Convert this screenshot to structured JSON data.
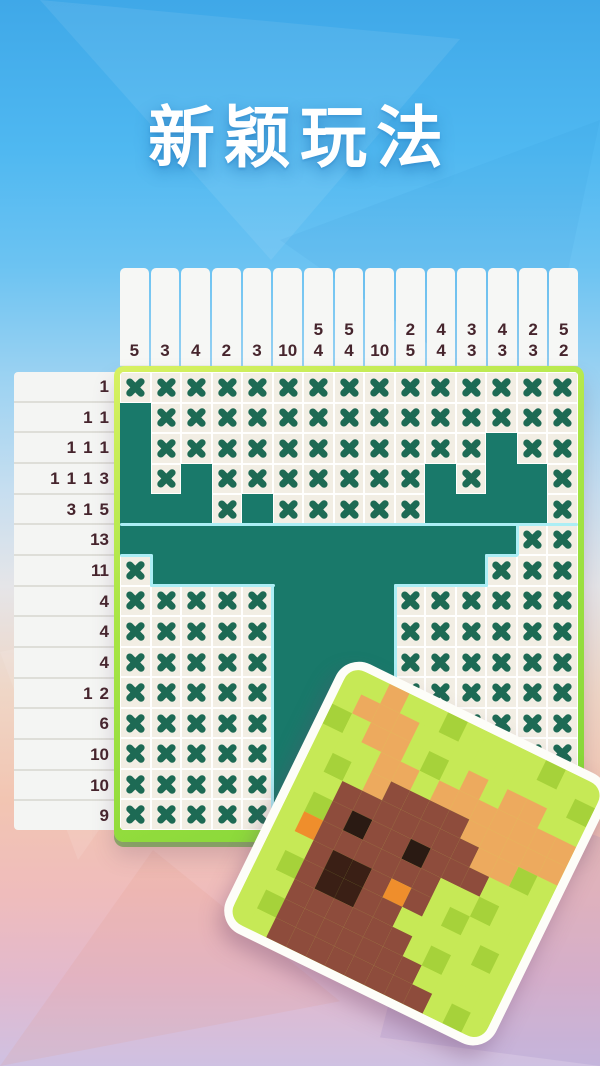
{
  "title": "新颖玩法",
  "colors": {
    "sky_blue": "#4fb8f1",
    "bottom_pink": "#efbcbc",
    "bottom_lavender": "#cfc1e2",
    "grid_border_green": "#a8e545",
    "cell_bg": "#f2eee4",
    "cell_filled_teal": "#19796a",
    "x_mark_green": "#1d6a54",
    "hint_text": "#46252d",
    "hint_strip_bg": "#f6f7f5",
    "highlight_cyan": "#aceef5",
    "card_border": "#fdfdf8"
  },
  "puzzle": {
    "size": 15,
    "col_hints": [
      [
        5
      ],
      [
        3
      ],
      [
        4
      ],
      [
        2
      ],
      [
        3
      ],
      [
        10
      ],
      [
        5,
        4
      ],
      [
        5,
        4
      ],
      [
        10
      ],
      [
        2,
        5
      ],
      [
        4,
        4
      ],
      [
        3,
        3
      ],
      [
        4,
        3
      ],
      [
        2,
        3
      ],
      [
        5,
        2
      ]
    ],
    "row_hints": [
      [
        1
      ],
      [
        1,
        1
      ],
      [
        1,
        1,
        1
      ],
      [
        1,
        1,
        1,
        3
      ],
      [
        3,
        1,
        5
      ],
      [
        13
      ],
      [
        11
      ],
      [
        4
      ],
      [
        4
      ],
      [
        4
      ],
      [
        1,
        2
      ],
      [
        6
      ],
      [
        10
      ],
      [
        10
      ],
      [
        9
      ]
    ],
    "cells": [
      "xxxxxxxxxxxxxxx",
      "fxxxxxxxxxxxxxx",
      "fxxxxxxxxxxxfxx",
      "fxfxxxxxxxfxffx",
      "fffxfxxxxxffffx",
      "fffffffffffffxx",
      "xfffffffffffxxx",
      "xxxxxffffxxxxxx",
      "xxxxxffffxxxxxx",
      "xxxxxffffxxxxxx",
      "xxxxxffffxxxxxx",
      "xxxxxffffxxxxxx",
      "xxxxxffffxxxxxx",
      "xxxxxffffxxxxxx",
      "xxxxxffffxxxxxx"
    ]
  },
  "preview_card": {
    "palette": {
      "L": "#c6e956",
      "D": "#a6d23a",
      "O": "#edaa5e",
      "B": "#8e4c3c",
      "K": "#2a1a13",
      "R": "#3a1f15",
      "N": "#ef8e2c"
    },
    "pixels": [
      "LLOLLDLLLLDLL",
      "LOOOLLLLLLLLD",
      "DLOOLDLOLOOLL",
      "LLLOOLOOOOOOO",
      "LDLOBBBBOOOOO",
      "LLBBBBBBBOODL",
      "LDBKBBKBBBLLL",
      "LNBBBBBBLLDLL",
      "LLBRRBNBLDLLL",
      "LDBRRBBLLLLDL",
      "LLBBBBBBLDLLL",
      "LDBBBBBBBLLLL",
      "LLBBBBBBBBLDL"
    ]
  }
}
